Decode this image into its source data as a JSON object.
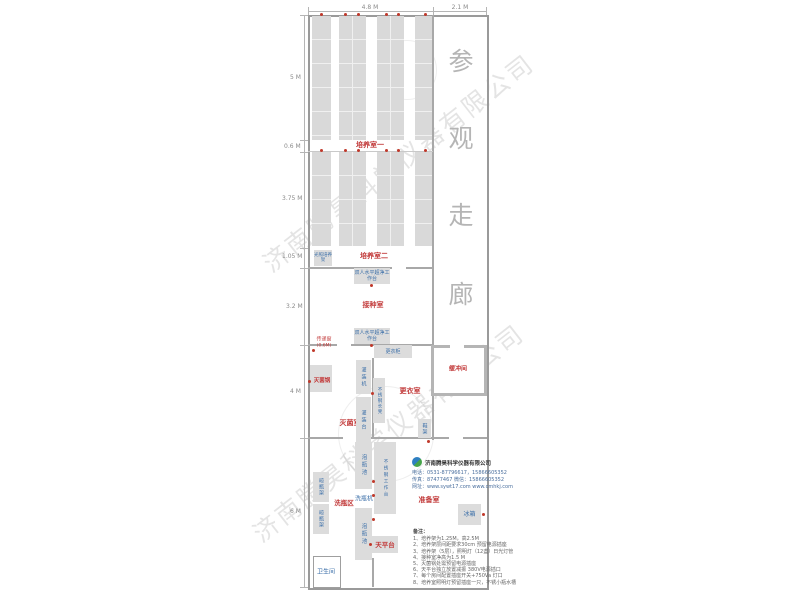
{
  "dimensions": {
    "top": {
      "left_span": "4.8 M",
      "right_span": "2.1 M"
    },
    "left": {
      "d1": "5 M",
      "d2": "0.6 M",
      "d3": "3.75 M",
      "d4": "1.05 M",
      "d5": "3.2 M",
      "d6": "4 M",
      "d7": "6 M"
    }
  },
  "corridor": {
    "c0": "参",
    "c1": "观",
    "c2": "走",
    "c3": "廊"
  },
  "rooms": {
    "culture1": "培养室一",
    "culture2": "培养室二",
    "inoculation": "接种室",
    "sterilization": "灭菌室",
    "changing": "更衣室",
    "buffer": "缓冲间",
    "washing": "洗瓶区",
    "prep": "准备室",
    "toilet": "卫生间"
  },
  "equipment": {
    "light_rack": "光照培养架",
    "bench1": "双人水平超净工作台",
    "bench2": "双人水平超净工作台",
    "pass_window": "传递窗",
    "pass_window_size": "(0.6M)",
    "locker": "更衣柜",
    "filler": "灌装机",
    "filling_table": "灌装台",
    "ss_bench": "不锈钢长凳",
    "autoclave": "灭菌锅",
    "shoe_rack": "鞋架",
    "dry_rack1": "晾瓶架",
    "dry_rack2": "晾瓶架",
    "soak_pool1": "泡瓶池",
    "washer": "洗瓶机",
    "ss_table": "不锈钢工作台",
    "soak_pool2": "泡瓶池",
    "balance": "天平台",
    "fridge": "冰箱"
  },
  "company": {
    "name": "济南腾昊科学仪器有限公司",
    "info1": "电话：0531-87796617，15866605352",
    "info2": "传真：87477467  微信：15866605352",
    "info3": "网址：www.sywt17.com  www.cmhkj.com"
  },
  "watermark": "济南腾昊科学仪器有限公司",
  "notes": {
    "title": "备注：",
    "n1": "1、培养架为1.25M，高2.5M",
    "n2": "2、培养架层间距要求30cm 预留电源插座",
    "n3": "3、培养架（5层），照明灯（12盏）日光灯管",
    "n4": "4、接种室净高为1.5 M",
    "n5": "5、灭菌锅处需预留电源插座",
    "n6": "6、天平台独立放置减振 380V电源插口",
    "n7": "7、每个房间配置插座开关+750Va 灯口",
    "n8": "8、培养室照明灯预留插座一只，不锈小瓶水槽"
  }
}
